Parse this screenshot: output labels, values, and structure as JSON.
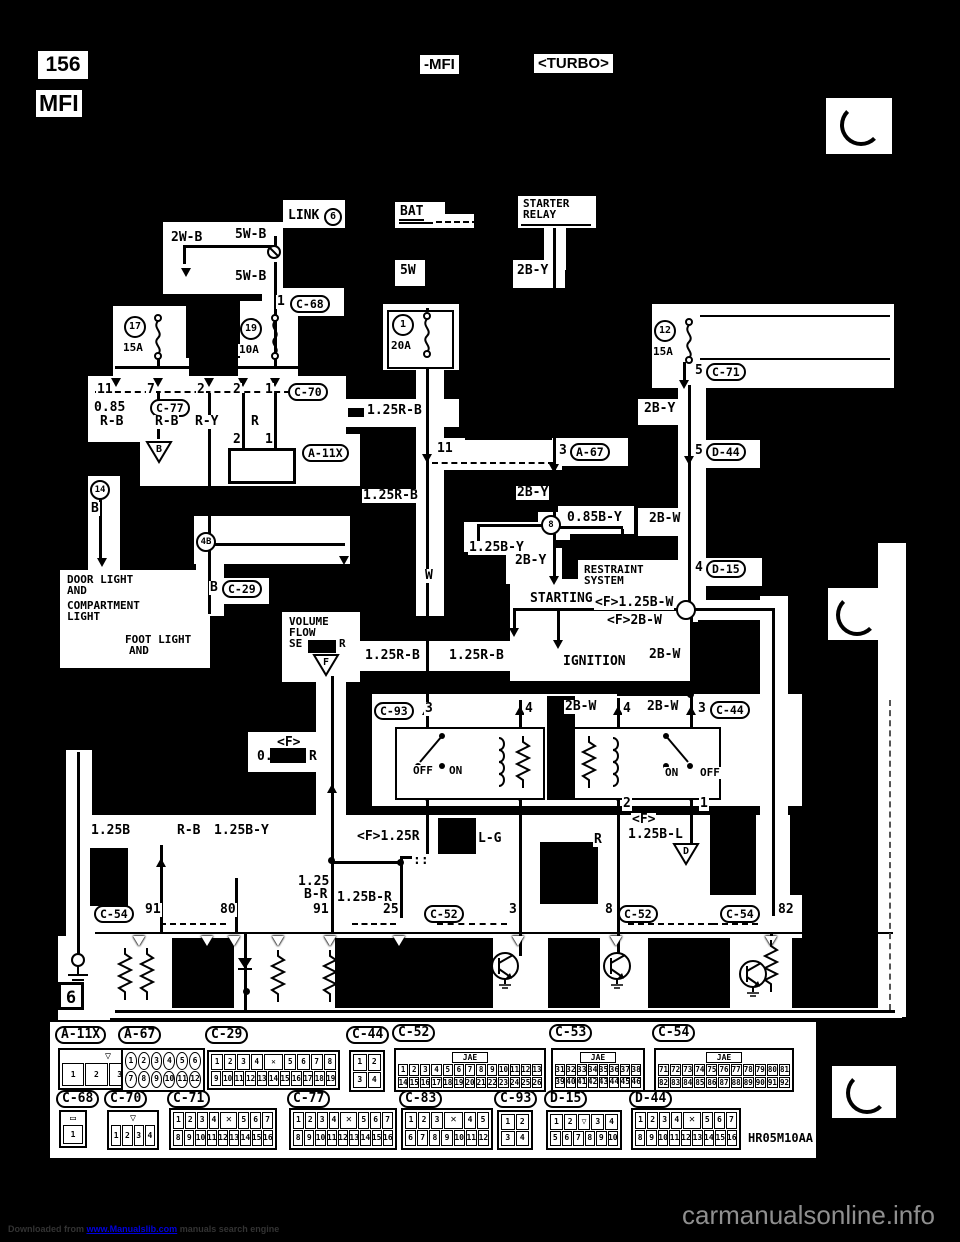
{
  "page": {
    "number": "156",
    "header_continue": "-MFI",
    "header_variant": "<TURBO>",
    "title": "MFI",
    "diagram_code": "HR05M10AA"
  },
  "footer": {
    "prefix": "Downloaded from ",
    "link": "www.Manualslib.com",
    "suffix": " manuals search engine",
    "watermark": "carmanualsonline.info"
  },
  "diagram": {
    "grid_ref": "6",
    "labels": [
      {
        "t": "LINK",
        "x": 287,
        "y": 209
      },
      {
        "t": "6",
        "x": 324,
        "y": 208,
        "c": 1
      },
      {
        "t": "2W-B",
        "x": 170,
        "y": 231
      },
      {
        "t": "5W-B",
        "x": 234,
        "y": 228
      },
      {
        "t": "5W-B",
        "x": 234,
        "y": 270
      },
      {
        "t": "1",
        "x": 276,
        "y": 295
      },
      {
        "t": "C-68",
        "x": 290,
        "y": 295,
        "p": 1
      },
      {
        "t": "BAT",
        "x": 399,
        "y": 205,
        "u": 1
      },
      {
        "t": "STARTER",
        "x": 522,
        "y": 198,
        "s": 1
      },
      {
        "t": "RELAY",
        "x": 522,
        "y": 209,
        "s": 1
      },
      {
        "t": "5W",
        "x": 399,
        "y": 264
      },
      {
        "t": "2B-Y",
        "x": 516,
        "y": 264
      },
      {
        "t": "5",
        "x": 694,
        "y": 364
      },
      {
        "t": "C-71",
        "x": 706,
        "y": 363,
        "p": 1
      },
      {
        "t": "11",
        "x": 96,
        "y": 383
      },
      {
        "t": "7",
        "x": 146,
        "y": 383
      },
      {
        "t": "2",
        "x": 196,
        "y": 383
      },
      {
        "t": "2",
        "x": 232,
        "y": 383
      },
      {
        "t": "1",
        "x": 264,
        "y": 383
      },
      {
        "t": "C-70",
        "x": 288,
        "y": 383,
        "p": 1
      },
      {
        "t": "0.85",
        "x": 93,
        "y": 401
      },
      {
        "t": "R-B",
        "x": 99,
        "y": 415
      },
      {
        "t": "C-77",
        "x": 150,
        "y": 399,
        "p": 1
      },
      {
        "t": "R-B",
        "x": 154,
        "y": 415
      },
      {
        "t": "R-Y",
        "x": 194,
        "y": 415
      },
      {
        "t": "R",
        "x": 250,
        "y": 415
      },
      {
        "t": "1.25R-B",
        "x": 366,
        "y": 404
      },
      {
        "t": "2",
        "x": 232,
        "y": 433
      },
      {
        "t": "1",
        "x": 264,
        "y": 433
      },
      {
        "t": "A-11X",
        "x": 302,
        "y": 444,
        "p": 1
      },
      {
        "t": "11",
        "x": 436,
        "y": 442
      },
      {
        "t": "3",
        "x": 558,
        "y": 444
      },
      {
        "t": "A-67",
        "x": 570,
        "y": 443,
        "p": 1
      },
      {
        "t": "2B-Y",
        "x": 643,
        "y": 402
      },
      {
        "t": "5",
        "x": 694,
        "y": 444
      },
      {
        "t": "D-44",
        "x": 706,
        "y": 443,
        "p": 1
      },
      {
        "t": "B",
        "x": 90,
        "y": 502
      },
      {
        "t": "1.25R-B",
        "x": 362,
        "y": 489
      },
      {
        "t": "2B-Y",
        "x": 516,
        "y": 486
      },
      {
        "t": "1.25B-Y",
        "x": 468,
        "y": 541
      },
      {
        "t": "0.85B-Y",
        "x": 566,
        "y": 511
      },
      {
        "t": "2B-W",
        "x": 648,
        "y": 512
      },
      {
        "t": "2B-Y",
        "x": 514,
        "y": 554
      },
      {
        "t": "RESTRAINT",
        "x": 583,
        "y": 564,
        "s": 1
      },
      {
        "t": "SYSTEM",
        "x": 583,
        "y": 575,
        "s": 1
      },
      {
        "t": "4",
        "x": 694,
        "y": 561
      },
      {
        "t": "D-15",
        "x": 706,
        "y": 560,
        "p": 1
      },
      {
        "t": "DOOR LIGHT",
        "x": 66,
        "y": 574,
        "s": 1
      },
      {
        "t": "AND",
        "x": 66,
        "y": 585,
        "s": 1
      },
      {
        "t": "COMPARTMENT",
        "x": 66,
        "y": 600,
        "s": 1
      },
      {
        "t": "LIGHT",
        "x": 66,
        "y": 611,
        "s": 1
      },
      {
        "t": "FOOT LIGHT",
        "x": 124,
        "y": 634,
        "s": 1
      },
      {
        "t": "AND",
        "x": 128,
        "y": 645,
        "s": 1
      },
      {
        "t": "B",
        "x": 209,
        "y": 581
      },
      {
        "t": "C-29",
        "x": 222,
        "y": 580,
        "p": 1
      },
      {
        "t": "STARTING",
        "x": 529,
        "y": 592
      },
      {
        "t": "<F>1.25B-W",
        "x": 594,
        "y": 596
      },
      {
        "t": "<F>2B-W",
        "x": 606,
        "y": 614
      },
      {
        "t": "IGNITION",
        "x": 562,
        "y": 655
      },
      {
        "t": "2B-W",
        "x": 648,
        "y": 648
      },
      {
        "t": "W",
        "x": 424,
        "y": 569
      },
      {
        "t": "VOLUME",
        "x": 288,
        "y": 616,
        "s": 1
      },
      {
        "t": "FLOW",
        "x": 288,
        "y": 627,
        "s": 1
      },
      {
        "t": "SE",
        "x": 288,
        "y": 638,
        "s": 1
      },
      {
        "t": "R",
        "x": 338,
        "y": 638,
        "s": 1
      },
      {
        "t": "1.25R-B",
        "x": 364,
        "y": 649
      },
      {
        "t": "1.25R-B",
        "x": 448,
        "y": 649
      },
      {
        "t": "<F>",
        "x": 276,
        "y": 736
      },
      {
        "t": "0.",
        "x": 256,
        "y": 750
      },
      {
        "t": "R",
        "x": 308,
        "y": 750
      },
      {
        "t": "C-93",
        "x": 374,
        "y": 702,
        "p": 1
      },
      {
        "t": "3",
        "x": 424,
        "y": 702
      },
      {
        "t": "4",
        "x": 524,
        "y": 702
      },
      {
        "t": "2B-W",
        "x": 564,
        "y": 700
      },
      {
        "t": "4",
        "x": 622,
        "y": 702
      },
      {
        "t": "2B-W",
        "x": 646,
        "y": 700
      },
      {
        "t": "3",
        "x": 697,
        "y": 702
      },
      {
        "t": "C-44",
        "x": 710,
        "y": 701,
        "p": 1
      },
      {
        "t": "OFF",
        "x": 412,
        "y": 765,
        "s": 1
      },
      {
        "t": "ON",
        "x": 448,
        "y": 765,
        "s": 1
      },
      {
        "t": "ON",
        "x": 664,
        "y": 767,
        "s": 1
      },
      {
        "t": "OFF",
        "x": 699,
        "y": 767,
        "s": 1
      },
      {
        "t": "2",
        "x": 622,
        "y": 797
      },
      {
        "t": "1",
        "x": 699,
        "y": 797
      },
      {
        "t": "<F>",
        "x": 631,
        "y": 813
      },
      {
        "t": "1.25B-L",
        "x": 627,
        "y": 828
      },
      {
        "t": "1.25B",
        "x": 90,
        "y": 824
      },
      {
        "t": "R-B",
        "x": 176,
        "y": 824
      },
      {
        "t": "1.25B-Y",
        "x": 213,
        "y": 824
      },
      {
        "t": "<F>1.25R",
        "x": 356,
        "y": 830
      },
      {
        "t": "::",
        "x": 412,
        "y": 854
      },
      {
        "t": "L-G",
        "x": 477,
        "y": 832
      },
      {
        "t": "R",
        "x": 593,
        "y": 833
      },
      {
        "t": "1.25",
        "x": 297,
        "y": 875
      },
      {
        "t": "B-R",
        "x": 303,
        "y": 888
      },
      {
        "t": "1.25B-R",
        "x": 336,
        "y": 891
      },
      {
        "t": "C-54",
        "x": 94,
        "y": 905,
        "p": 1
      },
      {
        "t": "91",
        "x": 144,
        "y": 903
      },
      {
        "t": "80",
        "x": 219,
        "y": 903
      },
      {
        "t": "91",
        "x": 312,
        "y": 903
      },
      {
        "t": "25",
        "x": 382,
        "y": 903
      },
      {
        "t": "C-52",
        "x": 424,
        "y": 905,
        "p": 1
      },
      {
        "t": "3",
        "x": 508,
        "y": 903
      },
      {
        "t": "8",
        "x": 604,
        "y": 903
      },
      {
        "t": "C-52",
        "x": 618,
        "y": 905,
        "p": 1
      },
      {
        "t": "C-54",
        "x": 720,
        "y": 905,
        "p": 1
      },
      {
        "t": "82",
        "x": 777,
        "y": 903
      }
    ],
    "fuses": [
      {
        "no": "17",
        "amps": "15A",
        "x": 124,
        "y": 316
      },
      {
        "no": "19",
        "amps": "10A",
        "x": 240,
        "y": 318
      },
      {
        "no": "1",
        "amps": "20A",
        "x": 392,
        "y": 314
      },
      {
        "no": "12",
        "amps": "15A",
        "x": 654,
        "y": 320
      }
    ],
    "grounds": [
      {
        "letter": "B",
        "x": 145,
        "y": 440
      },
      {
        "letter": "F",
        "x": 312,
        "y": 653
      },
      {
        "letter": "D",
        "x": 672,
        "y": 842
      }
    ],
    "junctions": [
      {
        "t": "14",
        "x": 90,
        "y": 480
      },
      {
        "t": "4B",
        "x": 196,
        "y": 532
      },
      {
        "t": "8",
        "x": 541,
        "y": 515
      },
      {
        "t": "",
        "x": 676,
        "y": 600
      }
    ]
  },
  "connectors": [
    {
      "id": "A-11X",
      "lx": 55,
      "ly": 1026,
      "x": 58,
      "y": 1048,
      "w": 100,
      "h": 42,
      "topsym": "▽",
      "rows": [
        [
          "1",
          "2",
          "3",
          "4"
        ]
      ]
    },
    {
      "id": "A-67",
      "lx": 118,
      "ly": 1026,
      "x": 121,
      "y": 1048,
      "w": 84,
      "h": 44,
      "round": 1,
      "rows": [
        [
          "1",
          "2",
          "3",
          "4",
          "5",
          "6"
        ],
        [
          "7",
          "8",
          "9",
          "10",
          "11",
          "12"
        ]
      ]
    },
    {
      "id": "C-29",
      "lx": 205,
      "ly": 1026,
      "x": 207,
      "y": 1050,
      "w": 133,
      "h": 40,
      "rows": [
        [
          "1",
          "2",
          "3",
          "4",
          "✕",
          "5",
          "6",
          "7",
          "8"
        ],
        [
          "9",
          "10",
          "11",
          "12",
          "13",
          "14",
          "15",
          "16",
          "17",
          "18",
          "19"
        ]
      ]
    },
    {
      "id": "C-44",
      "lx": 346,
      "ly": 1026,
      "x": 349,
      "y": 1050,
      "w": 36,
      "h": 42,
      "rows": [
        [
          "1",
          "2"
        ],
        [
          "3",
          "4"
        ]
      ]
    },
    {
      "id": "C-52",
      "lx": 392,
      "ly": 1024,
      "x": 394,
      "y": 1048,
      "w": 152,
      "h": 44,
      "jae": "JAE",
      "rows": [
        [
          "1",
          "2",
          "3",
          "4",
          "5",
          "6",
          "7",
          "8",
          "9",
          "10",
          "11",
          "12",
          "13"
        ],
        [
          "14",
          "15",
          "16",
          "17",
          "18",
          "19",
          "20",
          "21",
          "22",
          "23",
          "24",
          "25",
          "26"
        ]
      ]
    },
    {
      "id": "C-53",
      "lx": 549,
      "ly": 1024,
      "x": 551,
      "y": 1048,
      "w": 94,
      "h": 44,
      "jae": "JAE",
      "rows": [
        [
          "31",
          "32",
          "33",
          "34",
          "35",
          "36",
          "37",
          "38"
        ],
        [
          "39",
          "40",
          "41",
          "42",
          "43",
          "44",
          "45",
          "46"
        ]
      ]
    },
    {
      "id": "C-54",
      "lx": 652,
      "ly": 1024,
      "x": 654,
      "y": 1048,
      "w": 140,
      "h": 44,
      "jae": "JAE",
      "rows": [
        [
          "71",
          "72",
          "73",
          "74",
          "75",
          "76",
          "77",
          "78",
          "79",
          "80",
          "81"
        ],
        [
          "82",
          "83",
          "84",
          "85",
          "86",
          "87",
          "88",
          "89",
          "90",
          "91",
          "92"
        ]
      ]
    },
    {
      "id": "C-68",
      "lx": 56,
      "ly": 1090,
      "x": 59,
      "y": 1110,
      "w": 28,
      "h": 38,
      "topsym": "▭",
      "rows": [
        [
          "1"
        ]
      ]
    },
    {
      "id": "C-70",
      "lx": 104,
      "ly": 1090,
      "x": 107,
      "y": 1110,
      "w": 52,
      "h": 40,
      "topsym": "▽",
      "rows": [
        [
          "1",
          "2",
          "3",
          "4"
        ]
      ]
    },
    {
      "id": "C-71",
      "lx": 167,
      "ly": 1090,
      "x": 169,
      "y": 1108,
      "w": 108,
      "h": 42,
      "rows": [
        [
          "1",
          "2",
          "3",
          "4",
          "✕",
          "5",
          "6",
          "7"
        ],
        [
          "8",
          "9",
          "10",
          "11",
          "12",
          "13",
          "14",
          "15",
          "16"
        ]
      ]
    },
    {
      "id": "C-77",
      "lx": 287,
      "ly": 1090,
      "x": 289,
      "y": 1108,
      "w": 108,
      "h": 42,
      "rows": [
        [
          "1",
          "2",
          "3",
          "4",
          "✕",
          "5",
          "6",
          "7"
        ],
        [
          "8",
          "9",
          "10",
          "11",
          "12",
          "13",
          "14",
          "15",
          "16"
        ]
      ]
    },
    {
      "id": "C-83",
      "lx": 399,
      "ly": 1090,
      "x": 401,
      "y": 1108,
      "w": 92,
      "h": 42,
      "rows": [
        [
          "1",
          "2",
          "3",
          "✕",
          "4",
          "5"
        ],
        [
          "6",
          "7",
          "8",
          "9",
          "10",
          "11",
          "12"
        ]
      ]
    },
    {
      "id": "C-93",
      "lx": 494,
      "ly": 1090,
      "x": 497,
      "y": 1110,
      "w": 36,
      "h": 40,
      "rows": [
        [
          "1",
          "2"
        ],
        [
          "3",
          "4"
        ]
      ]
    },
    {
      "id": "D-15",
      "lx": 544,
      "ly": 1090,
      "x": 546,
      "y": 1110,
      "w": 76,
      "h": 40,
      "rows": [
        [
          "1",
          "2",
          "▽",
          "3",
          "4"
        ],
        [
          "5",
          "6",
          "7",
          "8",
          "9",
          "10"
        ]
      ]
    },
    {
      "id": "D-44",
      "lx": 629,
      "ly": 1090,
      "x": 631,
      "y": 1108,
      "w": 110,
      "h": 42,
      "rows": [
        [
          "1",
          "2",
          "3",
          "4",
          "✕",
          "5",
          "6",
          "7"
        ],
        [
          "8",
          "9",
          "10",
          "11",
          "12",
          "13",
          "14",
          "15",
          "16"
        ]
      ]
    }
  ]
}
